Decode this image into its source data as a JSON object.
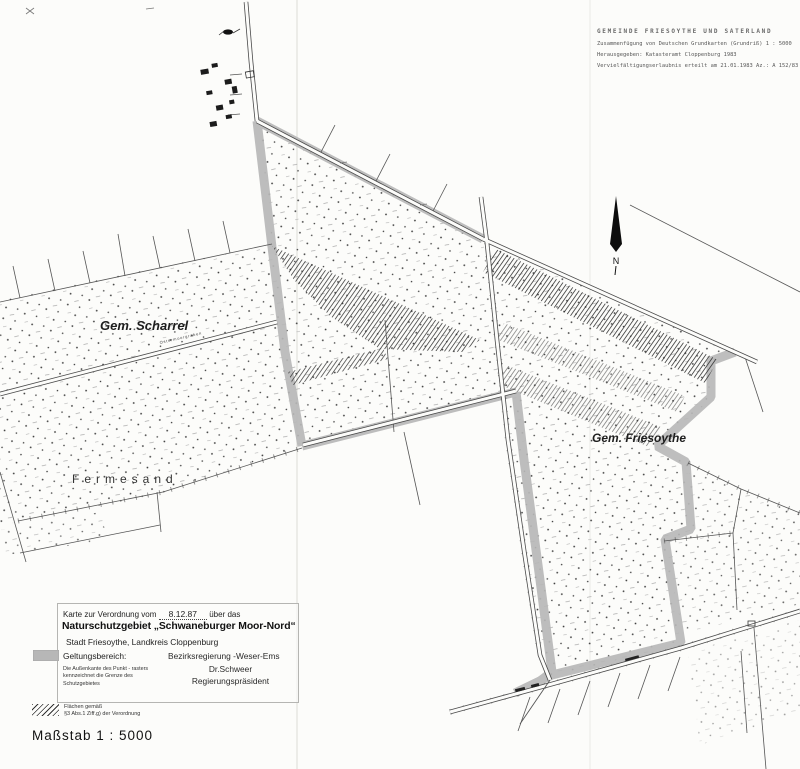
{
  "header_block": {
    "line1": "GEMEINDE FRIESOYTHE UND SATERLAND",
    "line2": "Zusammenfügung von Deutschen Grundkarten (Grundriß)  1 : 5000",
    "line3": "Herausgegeben:  Katasteramt Cloppenburg 1983",
    "line4": "Vervielfältigungserlaubnis erteilt am 21.01.1983 Az.: A 152/83"
  },
  "map_labels": {
    "municipality_left": "Gem. Scharrel",
    "area_name": "Fermesand",
    "municipality_right": "Gem. Friesoythe",
    "road_name": "Ostermoorgraben",
    "north_letter": "N"
  },
  "legend": {
    "intro_pre": "Karte zur Verordnung vom",
    "intro_date": "8.12.87",
    "intro_post": "über das",
    "title": "Naturschutzgebiet „Schwaneburger Moor-Nord“",
    "subtitle": "Stadt Friesoythe, Landkreis Cloppenburg",
    "scope_label": "Geltungsbereich:",
    "scope_note": "Die Außenkante des Punkt - rasters kennzeichnet die Grenze des Schutzgebietes",
    "authority": "Bezirksregierung -Weser-Ems",
    "signer_name": "Dr.Schweer",
    "signer_title": "Regierungspräsident",
    "hatch_label_line1": "Flächen gemäß",
    "hatch_label_line2": "§3 Abs.1 Ziff.g) der Verordnung",
    "scale": "Maßstab  1 : 5000"
  },
  "colors": {
    "paper": "#fcfcfa",
    "boundary_band_gray": "#b7b7b7",
    "ink": "#2a2a2a"
  }
}
